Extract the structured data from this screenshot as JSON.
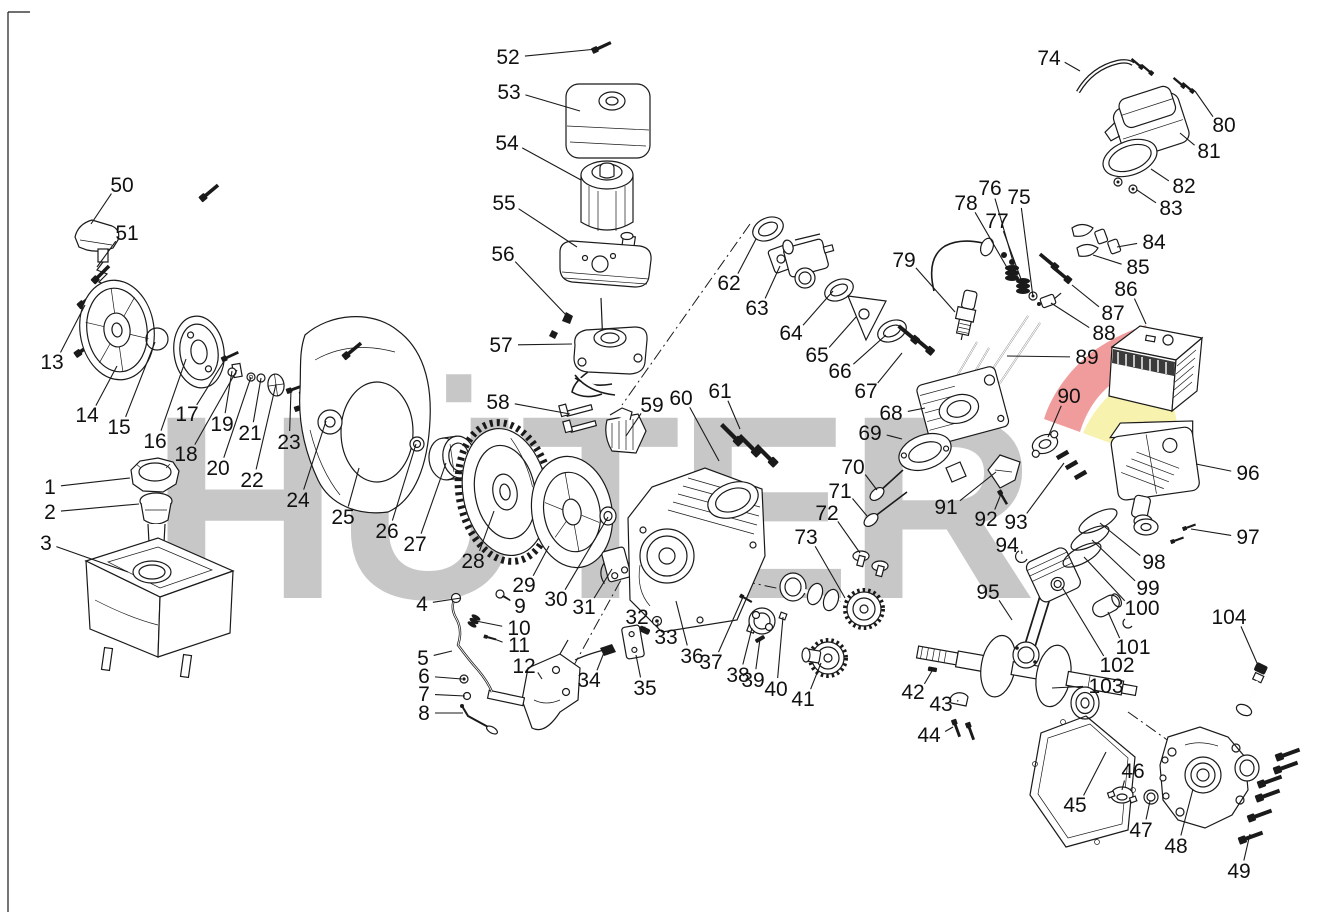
{
  "diagram": {
    "type": "exploded-parts-diagram",
    "canvas": {
      "width": 1339,
      "height": 912,
      "background": "#ffffff",
      "line_color": "#1a1a1a"
    },
    "watermark": {
      "text": "HÜTER",
      "color": "#c7c7c7",
      "arc_red": "#f09c9c",
      "arc_yellow": "#f7f2ad"
    },
    "part_count": 104,
    "part_labels": [
      {
        "n": "1",
        "x": 50,
        "y": 487,
        "tx": 130,
        "ty": 478
      },
      {
        "n": "2",
        "x": 50,
        "y": 512,
        "tx": 139,
        "ty": 504
      },
      {
        "n": "3",
        "x": 46,
        "y": 543,
        "tx": 128,
        "ty": 572
      },
      {
        "n": "4",
        "x": 422,
        "y": 604,
        "tx": 461,
        "ty": 598
      },
      {
        "n": "5",
        "x": 423,
        "y": 658,
        "tx": 452,
        "ty": 651
      },
      {
        "n": "6",
        "x": 424,
        "y": 676,
        "tx": 462,
        "ty": 679
      },
      {
        "n": "7",
        "x": 424,
        "y": 694,
        "tx": 465,
        "ty": 696
      },
      {
        "n": "8",
        "x": 424,
        "y": 713,
        "tx": 463,
        "ty": 713
      },
      {
        "n": "9",
        "x": 520,
        "y": 606,
        "tx": 502,
        "ty": 596
      },
      {
        "n": "10",
        "x": 519,
        "y": 628,
        "tx": 476,
        "ty": 621
      },
      {
        "n": "11",
        "x": 519,
        "y": 645,
        "tx": 489,
        "ty": 637
      },
      {
        "n": "12",
        "x": 524,
        "y": 666,
        "tx": 542,
        "ty": 679
      },
      {
        "n": "13",
        "x": 52,
        "y": 362,
        "tx": 85,
        "ty": 305
      },
      {
        "n": "14",
        "x": 87,
        "y": 415,
        "tx": 117,
        "ty": 366
      },
      {
        "n": "15",
        "x": 119,
        "y": 427,
        "tx": 155,
        "ty": 342
      },
      {
        "n": "16",
        "x": 155,
        "y": 441,
        "tx": 186,
        "ty": 359
      },
      {
        "n": "17",
        "x": 187,
        "y": 414,
        "tx": 226,
        "ty": 358
      },
      {
        "n": "18",
        "x": 186,
        "y": 454,
        "tx": 237,
        "ty": 370
      },
      {
        "n": "19",
        "x": 222,
        "y": 424,
        "tx": 232,
        "ty": 371
      },
      {
        "n": "20",
        "x": 218,
        "y": 468,
        "tx": 251,
        "ty": 377
      },
      {
        "n": "21",
        "x": 250,
        "y": 433,
        "tx": 261,
        "ty": 378
      },
      {
        "n": "22",
        "x": 252,
        "y": 480,
        "tx": 276,
        "ty": 384
      },
      {
        "n": "23",
        "x": 289,
        "y": 442,
        "tx": 291,
        "ty": 390
      },
      {
        "n": "24",
        "x": 298,
        "y": 500,
        "tx": 326,
        "ty": 421
      },
      {
        "n": "25",
        "x": 343,
        "y": 517,
        "tx": 359,
        "ty": 468
      },
      {
        "n": "26",
        "x": 387,
        "y": 531,
        "tx": 416,
        "ty": 444
      },
      {
        "n": "27",
        "x": 415,
        "y": 544,
        "tx": 446,
        "ty": 463
      },
      {
        "n": "28",
        "x": 473,
        "y": 561,
        "tx": 494,
        "ty": 511
      },
      {
        "n": "29",
        "x": 524,
        "y": 585,
        "tx": 549,
        "ty": 546
      },
      {
        "n": "30",
        "x": 556,
        "y": 599,
        "tx": 608,
        "ty": 517
      },
      {
        "n": "31",
        "x": 584,
        "y": 607,
        "tx": 612,
        "ty": 569
      },
      {
        "n": "32",
        "x": 637,
        "y": 617,
        "tx": 644,
        "ty": 630
      },
      {
        "n": "33",
        "x": 666,
        "y": 637,
        "tx": 658,
        "ty": 623
      },
      {
        "n": "34",
        "x": 589,
        "y": 680,
        "tx": 605,
        "ty": 650
      },
      {
        "n": "35",
        "x": 645,
        "y": 688,
        "tx": 636,
        "ty": 655
      },
      {
        "n": "36",
        "x": 692,
        "y": 656,
        "tx": 676,
        "ty": 601
      },
      {
        "n": "37",
        "x": 711,
        "y": 662,
        "tx": 743,
        "ty": 597
      },
      {
        "n": "38",
        "x": 738,
        "y": 675,
        "tx": 752,
        "ty": 628
      },
      {
        "n": "39",
        "x": 753,
        "y": 680,
        "tx": 760,
        "ty": 639
      },
      {
        "n": "40",
        "x": 776,
        "y": 689,
        "tx": 783,
        "ty": 617
      },
      {
        "n": "41",
        "x": 803,
        "y": 699,
        "tx": 821,
        "ty": 663
      },
      {
        "n": "42",
        "x": 913,
        "y": 692,
        "tx": 932,
        "ty": 671
      },
      {
        "n": "43",
        "x": 941,
        "y": 704,
        "tx": 958,
        "ty": 700
      },
      {
        "n": "44",
        "x": 929,
        "y": 735,
        "tx": 953,
        "ty": 727
      },
      {
        "n": "45",
        "x": 1075,
        "y": 805,
        "tx": 1106,
        "ty": 752
      },
      {
        "n": "46",
        "x": 1133,
        "y": 771,
        "tx": 1122,
        "ty": 790
      },
      {
        "n": "47",
        "x": 1141,
        "y": 830,
        "tx": 1150,
        "ty": 801
      },
      {
        "n": "48",
        "x": 1176,
        "y": 846,
        "tx": 1193,
        "ty": 789
      },
      {
        "n": "49",
        "x": 1239,
        "y": 871,
        "tx": 1250,
        "ty": 834
      },
      {
        "n": "50",
        "x": 122,
        "y": 185,
        "tx": 91,
        "ty": 224
      },
      {
        "n": "51",
        "x": 127,
        "y": 233,
        "tx": 97,
        "ty": 267
      },
      {
        "n": "52",
        "x": 508,
        "y": 57,
        "tx": 597,
        "ty": 49
      },
      {
        "n": "53",
        "x": 509,
        "y": 92,
        "tx": 580,
        "ty": 111
      },
      {
        "n": "54",
        "x": 507,
        "y": 143,
        "tx": 581,
        "ty": 180
      },
      {
        "n": "55",
        "x": 504,
        "y": 203,
        "tx": 577,
        "ty": 247
      },
      {
        "n": "56",
        "x": 503,
        "y": 254,
        "tx": 567,
        "ty": 316
      },
      {
        "n": "57",
        "x": 501,
        "y": 345,
        "tx": 572,
        "ty": 344
      },
      {
        "n": "58",
        "x": 498,
        "y": 402,
        "tx": 570,
        "ty": 414
      },
      {
        "n": "59",
        "x": 652,
        "y": 405,
        "tx": 626,
        "ty": 436
      },
      {
        "n": "60",
        "x": 681,
        "y": 398,
        "tx": 719,
        "ty": 461
      },
      {
        "n": "61",
        "x": 720,
        "y": 391,
        "tx": 740,
        "ty": 429
      },
      {
        "n": "62",
        "x": 729,
        "y": 283,
        "tx": 756,
        "ty": 239
      },
      {
        "n": "63",
        "x": 757,
        "y": 308,
        "tx": 780,
        "ty": 266
      },
      {
        "n": "64",
        "x": 791,
        "y": 333,
        "tx": 833,
        "ty": 291
      },
      {
        "n": "65",
        "x": 817,
        "y": 355,
        "tx": 856,
        "ty": 317
      },
      {
        "n": "66",
        "x": 840,
        "y": 371,
        "tx": 886,
        "ty": 335
      },
      {
        "n": "67",
        "x": 866,
        "y": 391,
        "tx": 902,
        "ty": 353
      },
      {
        "n": "68",
        "x": 891,
        "y": 413,
        "tx": 925,
        "ty": 408
      },
      {
        "n": "69",
        "x": 870,
        "y": 433,
        "tx": 902,
        "ty": 439
      },
      {
        "n": "70",
        "x": 853,
        "y": 467,
        "tx": 877,
        "ty": 490
      },
      {
        "n": "71",
        "x": 840,
        "y": 491,
        "tx": 867,
        "ty": 516
      },
      {
        "n": "72",
        "x": 827,
        "y": 513,
        "tx": 860,
        "ty": 553
      },
      {
        "n": "73",
        "x": 806,
        "y": 537,
        "tx": 845,
        "ty": 598
      },
      {
        "n": "74",
        "x": 1049,
        "y": 58,
        "tx": 1080,
        "ty": 71
      },
      {
        "n": "75",
        "x": 1019,
        "y": 197,
        "tx": 1033,
        "ty": 297
      },
      {
        "n": "76",
        "x": 990,
        "y": 188,
        "tx": 1018,
        "ty": 279
      },
      {
        "n": "77",
        "x": 997,
        "y": 221,
        "tx": 1025,
        "ty": 290
      },
      {
        "n": "78",
        "x": 966,
        "y": 203,
        "tx": 1009,
        "ty": 271
      },
      {
        "n": "79",
        "x": 904,
        "y": 260,
        "tx": 955,
        "ty": 312
      },
      {
        "n": "80",
        "x": 1224,
        "y": 125,
        "tx": 1195,
        "ty": 91
      },
      {
        "n": "81",
        "x": 1209,
        "y": 151,
        "tx": 1180,
        "ty": 133
      },
      {
        "n": "82",
        "x": 1184,
        "y": 186,
        "tx": 1151,
        "ty": 169
      },
      {
        "n": "83",
        "x": 1171,
        "y": 208,
        "tx": 1137,
        "ty": 190
      },
      {
        "n": "84",
        "x": 1154,
        "y": 242,
        "tx": 1117,
        "ty": 247
      },
      {
        "n": "85",
        "x": 1138,
        "y": 267,
        "tx": 1093,
        "ty": 255
      },
      {
        "n": "86",
        "x": 1126,
        "y": 289,
        "tx": 1146,
        "ty": 324
      },
      {
        "n": "87",
        "x": 1113,
        "y": 313,
        "tx": 1072,
        "ty": 285
      },
      {
        "n": "88",
        "x": 1104,
        "y": 333,
        "tx": 1051,
        "ty": 303
      },
      {
        "n": "89",
        "x": 1087,
        "y": 357,
        "tx": 1007,
        "ty": 356
      },
      {
        "n": "90",
        "x": 1069,
        "y": 396,
        "tx": 1048,
        "ty": 437
      },
      {
        "n": "91",
        "x": 946,
        "y": 507,
        "tx": 996,
        "ty": 472
      },
      {
        "n": "92",
        "x": 986,
        "y": 519,
        "tx": 1001,
        "ty": 494
      },
      {
        "n": "93",
        "x": 1016,
        "y": 522,
        "tx": 1064,
        "ty": 463
      },
      {
        "n": "94",
        "x": 1007,
        "y": 545,
        "tx": 1022,
        "ty": 554
      },
      {
        "n": "95",
        "x": 988,
        "y": 592,
        "tx": 1012,
        "ty": 620
      },
      {
        "n": "96",
        "x": 1248,
        "y": 473,
        "tx": 1196,
        "ty": 464
      },
      {
        "n": "97",
        "x": 1248,
        "y": 537,
        "tx": 1191,
        "ty": 529
      },
      {
        "n": "98",
        "x": 1154,
        "y": 562,
        "tx": 1100,
        "ty": 523
      },
      {
        "n": "99",
        "x": 1148,
        "y": 588,
        "tx": 1092,
        "ty": 540
      },
      {
        "n": "100",
        "x": 1142,
        "y": 608,
        "tx": 1084,
        "ty": 557
      },
      {
        "n": "101",
        "x": 1133,
        "y": 647,
        "tx": 1108,
        "ty": 612
      },
      {
        "n": "102",
        "x": 1117,
        "y": 665,
        "tx": 1062,
        "ty": 587
      },
      {
        "n": "103",
        "x": 1106,
        "y": 686,
        "tx": 1052,
        "ty": 688
      },
      {
        "n": "104",
        "x": 1229,
        "y": 617,
        "tx": 1257,
        "ty": 663
      }
    ]
  }
}
